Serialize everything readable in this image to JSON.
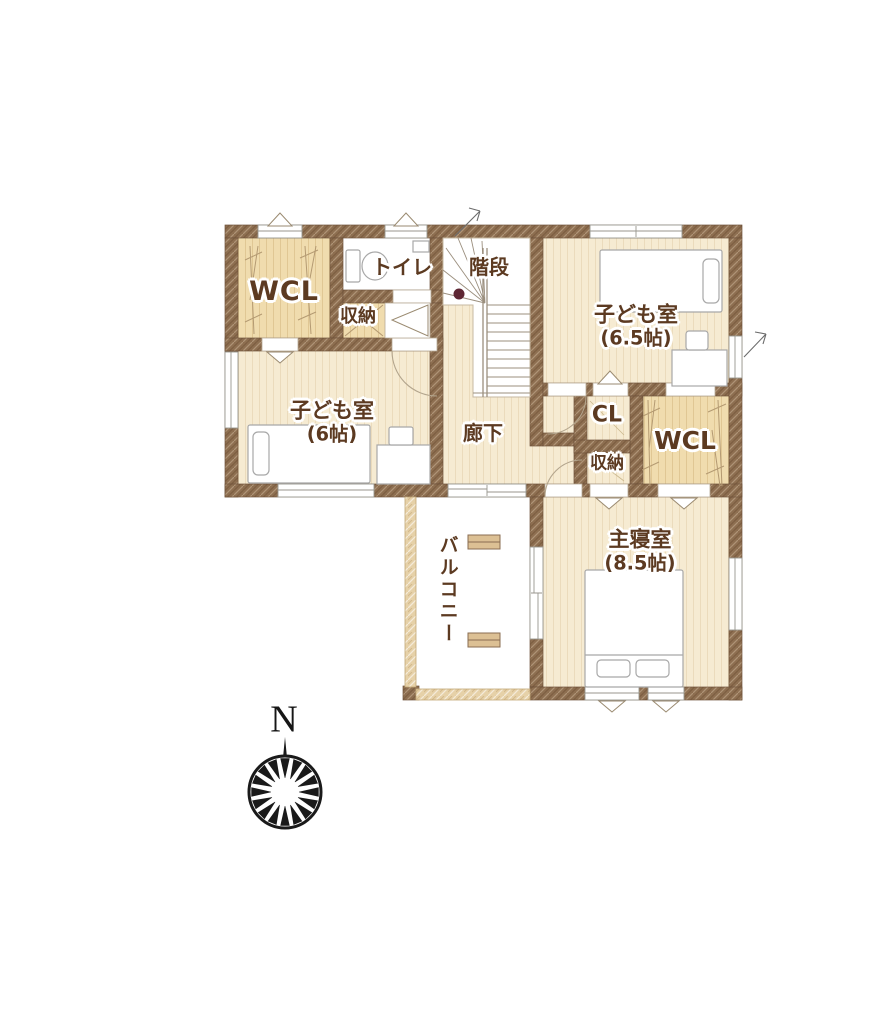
{
  "rooms": {
    "wcl_left": {
      "label": "WCL"
    },
    "toilet": {
      "label": "トイレ"
    },
    "stairs": {
      "label": "階段"
    },
    "kids_room_large": {
      "label": "子ども室",
      "size": "(6.5帖)"
    },
    "storage_upper": {
      "label": "収納"
    },
    "kids_room_small": {
      "label": "子ども室",
      "size": "(6帖)"
    },
    "hallway": {
      "label": "廊下"
    },
    "closet_cl": {
      "label": "CL"
    },
    "storage_middle": {
      "label": "収納"
    },
    "wcl_right": {
      "label": "WCL"
    },
    "balcony": {
      "label": "バルコニー"
    },
    "master_bedroom": {
      "label": "主寝室",
      "size": "(8.5帖)"
    }
  },
  "compass": {
    "north": "N"
  },
  "colors": {
    "wall": "#8d6e50",
    "floor": "#f6ebd2",
    "closet_floor": "#f0dcae",
    "balcony_wall": "#e6d1a8",
    "label_text": "#5c3a21",
    "stair_dot": "#5e2633",
    "compass_ink": "#1a1a1a"
  }
}
